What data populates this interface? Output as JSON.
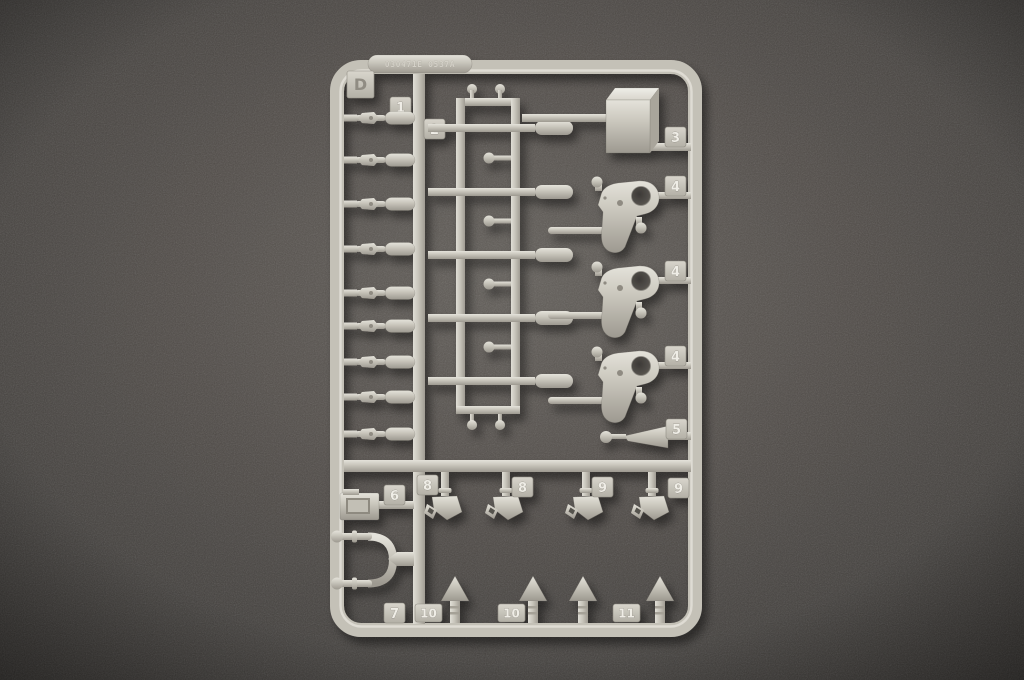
{
  "scene": {
    "type": "photograph",
    "subject": "Injection-molded plastic model kit sprue (runner D) lying on a dark felt surface",
    "background_color": "#4a4643",
    "plastic_color": "#c9c6bc"
  },
  "sprue": {
    "letter": "D",
    "embossed_code": "030471E 0537A",
    "tag_labels": {
      "d": "D",
      "n1": "1",
      "n2": "2",
      "n3": "3",
      "n4a": "4",
      "n4b": "4",
      "n4c": "4",
      "n5": "5",
      "n6": "6",
      "n7": "7",
      "n8a": "8",
      "n8b": "8",
      "n9a": "9",
      "n9b": "9",
      "n10a": "10",
      "n10b": "10",
      "n11": "11"
    }
  }
}
